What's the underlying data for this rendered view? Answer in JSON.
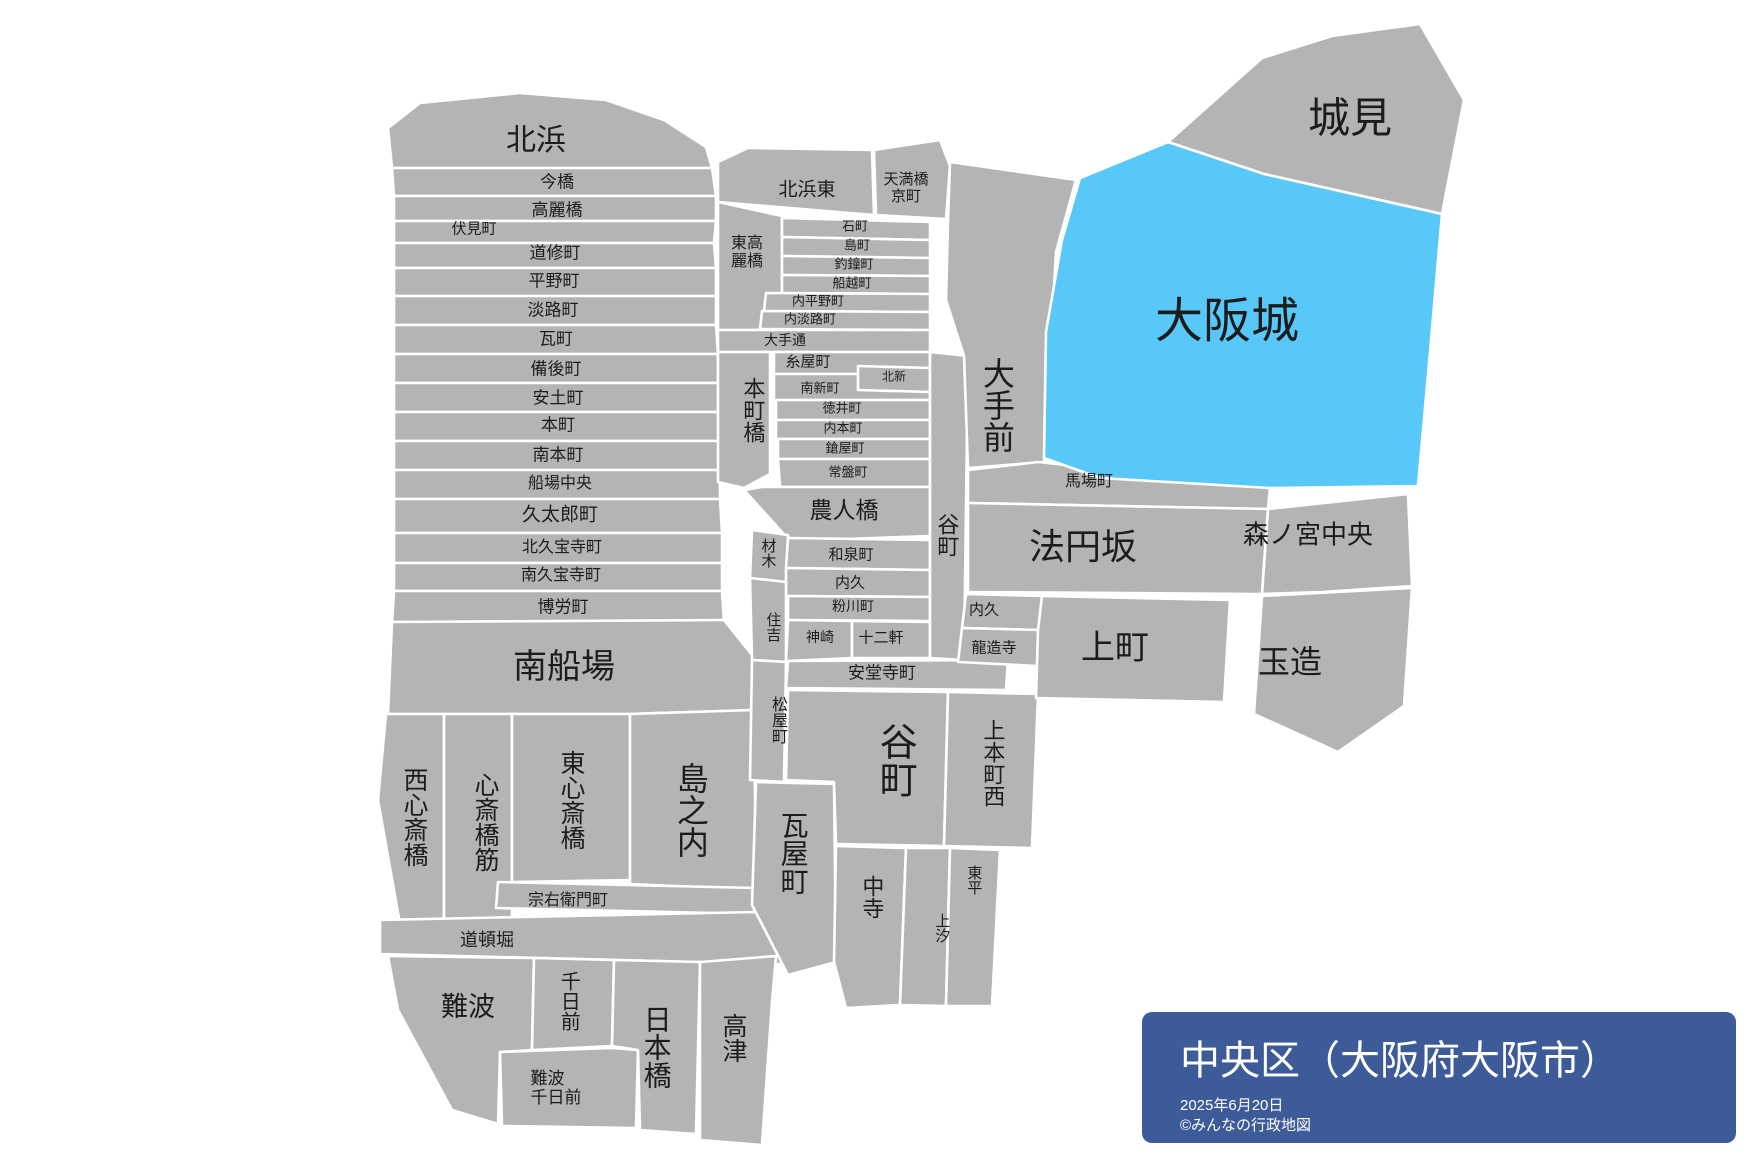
{
  "map": {
    "ward": "中央区",
    "highlighted_region": "大阪城",
    "labels": {
      "kitahama": "北浜",
      "imabashi": "今橋",
      "koraibashi": "高麗橋",
      "fushimimachi": "伏見町",
      "doshomachi": "道修町",
      "hiranomachi": "平野町",
      "awajimachi": "淡路町",
      "kawaramachi": "瓦町",
      "bingomachi": "備後町",
      "azuchimachi": "安土町",
      "hommachi": "本町",
      "minamihommachi": "南本町",
      "sembachuo": "船場中央",
      "kyutaromachi": "久太郎町",
      "kitakyuhojimachi": "北久宝寺町",
      "minamikyuhojimachi": "南久宝寺町",
      "bakuromachi": "博労町",
      "minamisemba": "南船場",
      "nishishinsaibashi": "西心斎橋",
      "shinsaibashisuji": "心斎橋筋",
      "higashishinsaibashi": "東心斎橋",
      "shimanouchi": "島之内",
      "soemoncho": "宗右衛門町",
      "dotombori": "道頓堀",
      "namba": "難波",
      "sennichimae": "千日前",
      "nambasennichimae": {
        "l1": "難波",
        "l2": "千日前"
      },
      "nipponbashi": "日本橋",
      "kozu": "高津",
      "kitahamahigashi": "北浜東",
      "temmabashikyomachi": {
        "l1": "天満橋",
        "l2": "京町"
      },
      "higashikoraibashi": {
        "l1": "東高",
        "l2": "麗橋"
      },
      "kokumachi": "石町",
      "shimamachi": "島町",
      "tsuriganecho": "釣鐘町",
      "funakoshimachi": "船越町",
      "uchihiranomachi": "内平野町",
      "uchiawajimachi": "内淡路町",
      "otedori": "大手通",
      "itoyamachi": "糸屋町",
      "kitashin": "北新",
      "minamishinmachi": "南新町",
      "tokuicho": "徳井町",
      "uchihommachi": "内本町",
      "yariyamachi": "鎗屋町",
      "tokiwamachi": "常盤町",
      "hommachibashi": "本町橋",
      "noninbashi": "農人橋",
      "zaimoku": "材木",
      "izumimachi": "和泉町",
      "uchikyu_west": "内久",
      "kokawacho": "粉川町",
      "sumiyoshi": "住吉",
      "kanzaki": "神崎",
      "junikken": "十二軒",
      "andojimachi": "安堂寺町",
      "matsuyamachi": "松屋町",
      "tanimachi_south": "谷町",
      "kawarayamachi": "瓦屋町",
      "nakadera": "中寺",
      "uehommachinishi": "上本町西",
      "tohei": "東平",
      "ueshio": "上汐",
      "tanimachi_north": "谷町",
      "otemae": "大手前",
      "babacho": "馬場町",
      "hoenzaka": "法円坂",
      "uchikyu_east": "内久",
      "ryuzoji": "龍造寺",
      "uemachi": "上町",
      "morinomiyachuo": "森ノ宮中央",
      "tamatsukuri": "玉造",
      "shiromi": "城見",
      "osakajo": "大阪城"
    }
  },
  "card": {
    "title": "中央区（大阪府大阪市）",
    "date": "2025年6月20日",
    "credit": "©みんなの行政地図"
  },
  "colors": {
    "region_fill": "#b4b4b4",
    "border": "#ffffff",
    "highlight_fill": "#58c8f8",
    "card_bg": "#3d5a99",
    "card_text": "#ffffff",
    "label_text": "#1c1c1c"
  }
}
